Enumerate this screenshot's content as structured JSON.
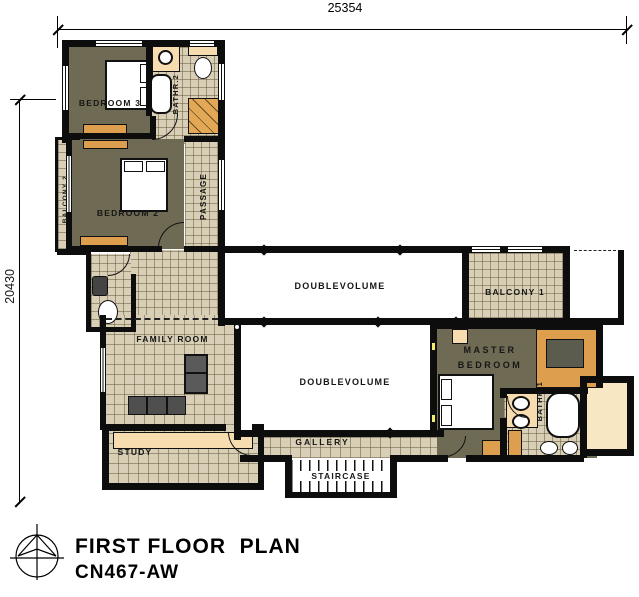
{
  "plan": {
    "title_line1": "FIRST FLOOR  PLAN",
    "title_line2": "CN467-AW",
    "dim_top": "25354",
    "dim_left": "20430",
    "labels": {
      "bedroom3": "BEDROOM 3",
      "bathr2": "BATHR.2",
      "balcony2": "BALCONY 2",
      "bedroom2": "BEDROOM 2",
      "passage": "PASSAGE",
      "double_volume_upper": "DOUBLEVOLUME",
      "double_volume_lower": "DOUBLEVOLUME",
      "balcony1": "BALCONY 1",
      "family_room": "FAMILY ROOM",
      "master_line1": "MASTER",
      "master_line2": "BEDROOM",
      "bathr1": "BATHR.1",
      "study": "STUDY",
      "gallery": "GALLERY",
      "staircase": "STAIRCASE"
    },
    "colors": {
      "wall": "#0d0d0d",
      "tile": "#d8cfb6",
      "bedroom_floor": "#6f6a53",
      "furniture": "#dd9f4d",
      "counter": "#f7dcb0",
      "terrace": "#f7e7c3"
    },
    "icons": {
      "compass": "north-arrow-compass"
    }
  }
}
